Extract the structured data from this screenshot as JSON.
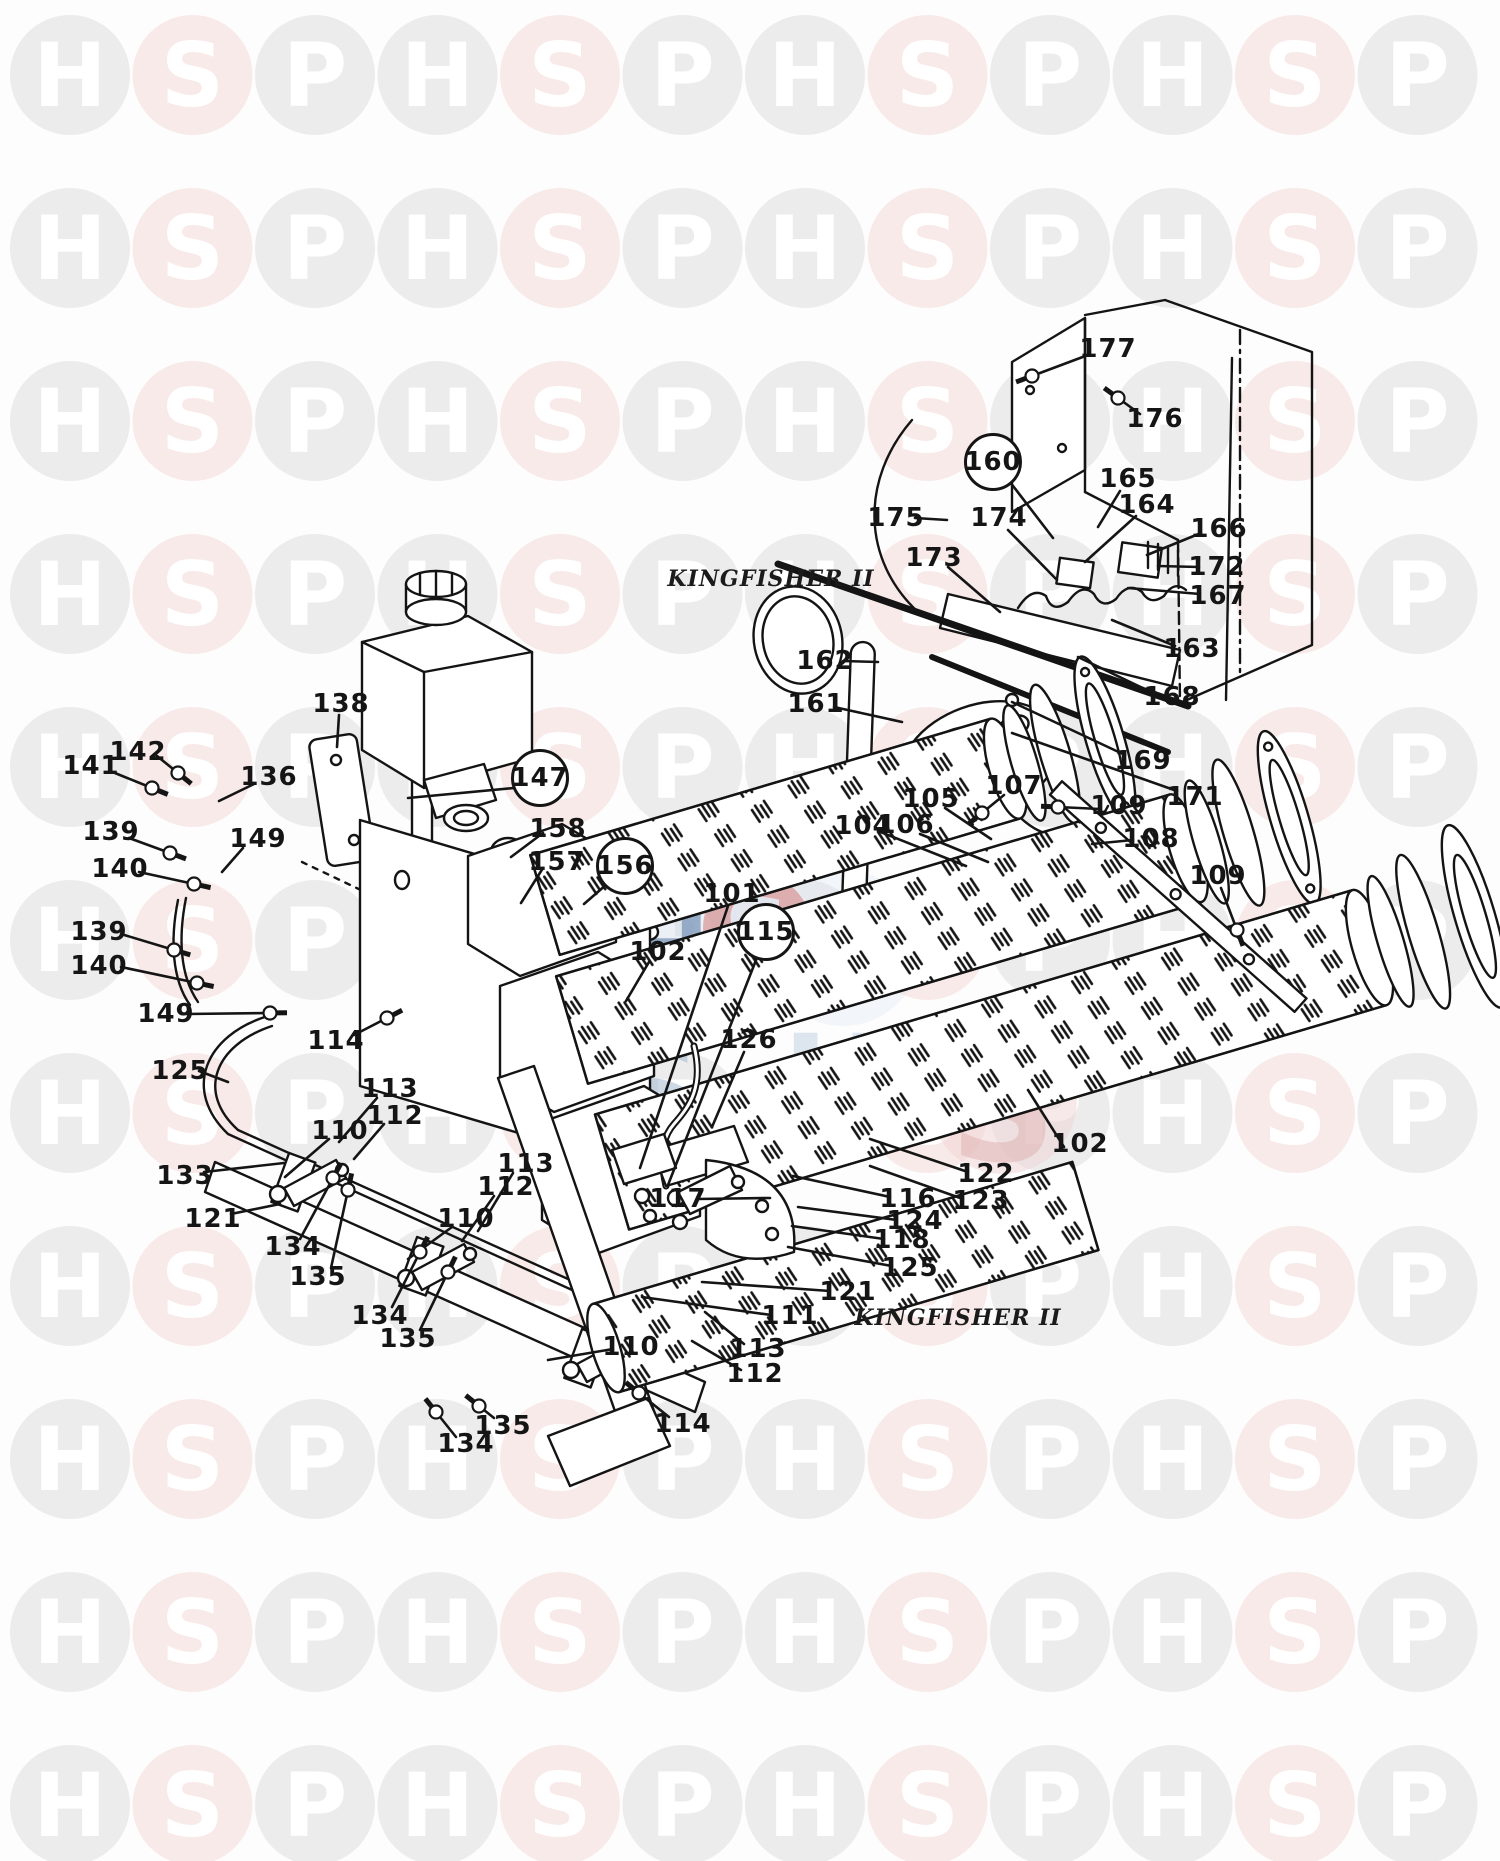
{
  "page": {
    "kind": "exploded-parts-diagram"
  },
  "titles": {
    "top": "KINGFISHER II",
    "bottom": "KINGFISHER II"
  },
  "watermark": {
    "letters": [
      "H",
      "S",
      "P"
    ],
    "gray_circle": "#ececec",
    "pink_circle": "#f8eae8",
    "letter_color": "#ffffff",
    "cols": 12,
    "rows": 11,
    "x0": 70,
    "y0": 75,
    "dx": 122.5,
    "dy": 173,
    "radius": 60,
    "font_size": 88
  },
  "center_logo": {
    "items": [
      {
        "type": "disc",
        "x": 660,
        "y": 950,
        "r": 85,
        "color": "#ccd9e8",
        "opacity": 0.4
      },
      {
        "type": "disc",
        "x": 843,
        "y": 948,
        "r": 78,
        "color": "#dce6f0",
        "opacity": 0.35
      },
      {
        "type": "disc",
        "x": 757,
        "y": 928,
        "r": 54,
        "color": "#d99494",
        "opacity": 0.7
      },
      {
        "type": "letter",
        "ch": "H",
        "x": 668,
        "y": 948,
        "size": 100,
        "color": "#7d97ba",
        "opacity": 0.75
      },
      {
        "type": "letter",
        "ch": "S",
        "x": 757,
        "y": 932,
        "size": 92,
        "color": "#e4edf5",
        "opacity": 0.9
      },
      {
        "type": "letter",
        "ch": "P",
        "x": 843,
        "y": 947,
        "size": 100,
        "color": "#7d97ba",
        "opacity": 0.75
      },
      {
        "type": "letter",
        "ch": "S",
        "x": 652,
        "y": 1092,
        "size": 148,
        "color": "#9fb5cf",
        "opacity": 0.5
      },
      {
        "type": "letter",
        "ch": "H",
        "x": 835,
        "y": 1080,
        "size": 126,
        "color": "#b8c9dc",
        "opacity": 0.45
      },
      {
        "type": "disc",
        "x": 1003,
        "y": 1100,
        "r": 74,
        "color": "#f0d4d4",
        "opacity": 0.5
      },
      {
        "type": "letter",
        "ch": "S",
        "x": 1003,
        "y": 1108,
        "size": 148,
        "color": "#dfb4b4",
        "opacity": 0.55
      }
    ]
  },
  "callouts": [
    {
      "t": "177",
      "x": 1108,
      "y": 349,
      "l": [
        1088,
        355,
        1032,
        376
      ],
      "b": 1
    },
    {
      "t": "176",
      "x": 1155,
      "y": 419,
      "l": [
        1140,
        414,
        1118,
        398
      ],
      "b": 1
    },
    {
      "t": "160",
      "x": 993,
      "y": 462,
      "c": 1,
      "l": [
        1010,
        482,
        1053,
        538
      ]
    },
    {
      "t": "165",
      "x": 1128,
      "y": 479,
      "l": [
        1120,
        491,
        1098,
        527
      ]
    },
    {
      "t": "164",
      "x": 1147,
      "y": 505,
      "l": [
        1136,
        516,
        1085,
        562
      ]
    },
    {
      "t": "166",
      "x": 1219,
      "y": 529,
      "l": [
        1201,
        533,
        1147,
        555
      ]
    },
    {
      "t": "172",
      "x": 1217,
      "y": 567,
      "l": [
        1199,
        567,
        1158,
        566
      ]
    },
    {
      "t": "167",
      "x": 1218,
      "y": 596,
      "l": [
        1200,
        594,
        1128,
        588
      ]
    },
    {
      "t": "163",
      "x": 1192,
      "y": 649,
      "l": [
        1175,
        646,
        1112,
        620
      ]
    },
    {
      "t": "168",
      "x": 1172,
      "y": 697,
      "l": [
        1155,
        694,
        1078,
        657
      ]
    },
    {
      "t": "169",
      "x": 1143,
      "y": 761,
      "l": [
        1125,
        755,
        1012,
        702
      ]
    },
    {
      "t": "171",
      "x": 1195,
      "y": 797,
      "l": [
        1177,
        791,
        1012,
        733
      ]
    },
    {
      "t": "175",
      "x": 896,
      "y": 518,
      "l": [
        915,
        518,
        947,
        520
      ]
    },
    {
      "t": "174",
      "x": 999,
      "y": 518,
      "l": [
        1008,
        530,
        1057,
        580
      ]
    },
    {
      "t": "173",
      "x": 934,
      "y": 558,
      "l": [
        948,
        567,
        1000,
        612
      ]
    },
    {
      "t": "162",
      "x": 825,
      "y": 661,
      "l": [
        843,
        661,
        878,
        662
      ]
    },
    {
      "t": "161",
      "x": 816,
      "y": 704,
      "l": [
        834,
        707,
        902,
        722
      ]
    },
    {
      "t": "138",
      "x": 341,
      "y": 704,
      "l": [
        339,
        715,
        337,
        747
      ]
    },
    {
      "t": "142",
      "x": 138,
      "y": 752,
      "l": [
        157,
        756,
        178,
        773
      ],
      "b": 1
    },
    {
      "t": "141",
      "x": 91,
      "y": 766,
      "l": [
        110,
        771,
        152,
        788
      ],
      "b": 1
    },
    {
      "t": "136",
      "x": 269,
      "y": 777,
      "l": [
        254,
        784,
        219,
        801
      ]
    },
    {
      "t": "139",
      "x": 111,
      "y": 832,
      "l": [
        129,
        838,
        170,
        853
      ],
      "b": 1
    },
    {
      "t": "149",
      "x": 258,
      "y": 839,
      "l": [
        243,
        848,
        222,
        872
      ]
    },
    {
      "t": "140",
      "x": 120,
      "y": 869,
      "l": [
        139,
        872,
        194,
        884
      ],
      "b": 1
    },
    {
      "t": "147",
      "x": 540,
      "y": 778,
      "c": 1,
      "l": [
        514,
        788,
        408,
        798
      ]
    },
    {
      "t": "158",
      "x": 558,
      "y": 829,
      "l": [
        543,
        833,
        511,
        857
      ]
    },
    {
      "t": "157",
      "x": 557,
      "y": 862,
      "l": [
        543,
        868,
        521,
        903
      ]
    },
    {
      "t": "156",
      "x": 625,
      "y": 866,
      "c": 1,
      "l": [
        607,
        884,
        584,
        904
      ]
    },
    {
      "t": "139",
      "x": 99,
      "y": 932,
      "l": [
        121,
        934,
        174,
        950
      ],
      "b": 1
    },
    {
      "t": "140",
      "x": 99,
      "y": 966,
      "l": [
        121,
        967,
        197,
        983
      ],
      "b": 1
    },
    {
      "t": "149",
      "x": 166,
      "y": 1014,
      "l": [
        186,
        1014,
        270,
        1013
      ],
      "b": 1
    },
    {
      "t": "114",
      "x": 336,
      "y": 1041,
      "l": [
        354,
        1035,
        387,
        1018
      ],
      "b": 1
    },
    {
      "t": "125",
      "x": 180,
      "y": 1071,
      "l": [
        199,
        1071,
        228,
        1082
      ]
    },
    {
      "t": "101",
      "x": 732,
      "y": 894,
      "l": [
        728,
        906,
        640,
        1168
      ]
    },
    {
      "t": "115",
      "x": 766,
      "y": 932,
      "c": 1,
      "l": [
        758,
        955,
        668,
        1185
      ]
    },
    {
      "t": "102",
      "x": 658,
      "y": 952,
      "l": [
        649,
        962,
        626,
        1001
      ]
    },
    {
      "t": "104",
      "x": 863,
      "y": 826,
      "l": [
        878,
        831,
        966,
        866
      ]
    },
    {
      "t": "106",
      "x": 906,
      "y": 825,
      "l": [
        920,
        834,
        988,
        862
      ]
    },
    {
      "t": "105",
      "x": 931,
      "y": 799,
      "l": [
        945,
        808,
        991,
        839
      ]
    },
    {
      "t": "107",
      "x": 1014,
      "y": 786,
      "l": [
        1004,
        795,
        982,
        813
      ],
      "b": 1
    },
    {
      "t": "109",
      "x": 1119,
      "y": 806,
      "l": [
        1100,
        809,
        1058,
        807
      ],
      "b": 1
    },
    {
      "t": "108",
      "x": 1151,
      "y": 839,
      "l": [
        1133,
        840,
        1092,
        844
      ]
    },
    {
      "t": "109",
      "x": 1218,
      "y": 876,
      "l": [
        1221,
        888,
        1237,
        930
      ],
      "b": 1
    },
    {
      "t": "126",
      "x": 749,
      "y": 1040,
      "l": [
        744,
        1052,
        712,
        1127
      ]
    },
    {
      "t": "102",
      "x": 1080,
      "y": 1144,
      "l": [
        1064,
        1147,
        1028,
        1090
      ]
    },
    {
      "t": "122",
      "x": 986,
      "y": 1174,
      "l": [
        968,
        1172,
        870,
        1139
      ]
    },
    {
      "t": "123",
      "x": 981,
      "y": 1201,
      "l": [
        963,
        1199,
        870,
        1166
      ]
    },
    {
      "t": "113",
      "x": 390,
      "y": 1089,
      "l": [
        377,
        1098,
        339,
        1142
      ]
    },
    {
      "t": "112",
      "x": 395,
      "y": 1116,
      "l": [
        384,
        1124,
        354,
        1159
      ]
    },
    {
      "t": "110",
      "x": 340,
      "y": 1131,
      "l": [
        329,
        1139,
        285,
        1177
      ]
    },
    {
      "t": "133",
      "x": 185,
      "y": 1176,
      "l": [
        204,
        1172,
        284,
        1163
      ]
    },
    {
      "t": "121",
      "x": 213,
      "y": 1219,
      "l": [
        231,
        1214,
        280,
        1204
      ]
    },
    {
      "t": "134",
      "x": 293,
      "y": 1247,
      "l": [
        300,
        1239,
        333,
        1178
      ],
      "b": 1
    },
    {
      "t": "135",
      "x": 318,
      "y": 1277,
      "l": [
        331,
        1268,
        348,
        1190
      ],
      "b": 1
    },
    {
      "t": "110",
      "x": 466,
      "y": 1219,
      "l": [
        452,
        1227,
        408,
        1259
      ]
    },
    {
      "t": "112",
      "x": 506,
      "y": 1187,
      "l": [
        494,
        1196,
        462,
        1241
      ]
    },
    {
      "t": "113",
      "x": 526,
      "y": 1164,
      "l": [
        513,
        1173,
        478,
        1231
      ]
    },
    {
      "t": "134",
      "x": 380,
      "y": 1316,
      "l": [
        392,
        1307,
        420,
        1252
      ],
      "b": 1
    },
    {
      "t": "135",
      "x": 408,
      "y": 1339,
      "l": [
        420,
        1330,
        448,
        1272
      ],
      "b": 1
    },
    {
      "t": "117",
      "x": 678,
      "y": 1199,
      "l": [
        698,
        1199,
        770,
        1198
      ]
    },
    {
      "t": "116",
      "x": 908,
      "y": 1199,
      "l": [
        890,
        1197,
        793,
        1176
      ]
    },
    {
      "t": "124",
      "x": 915,
      "y": 1221,
      "l": [
        897,
        1220,
        798,
        1207
      ]
    },
    {
      "t": "118",
      "x": 902,
      "y": 1240,
      "l": [
        884,
        1239,
        792,
        1226
      ]
    },
    {
      "t": "125",
      "x": 910,
      "y": 1268,
      "l": [
        892,
        1266,
        788,
        1247
      ]
    },
    {
      "t": "121",
      "x": 848,
      "y": 1292,
      "l": [
        830,
        1291,
        702,
        1282
      ]
    },
    {
      "t": "111",
      "x": 790,
      "y": 1316,
      "l": [
        771,
        1315,
        642,
        1297
      ]
    },
    {
      "t": "110",
      "x": 631,
      "y": 1347,
      "l": [
        613,
        1349,
        548,
        1360
      ]
    },
    {
      "t": "113",
      "x": 758,
      "y": 1349,
      "l": [
        744,
        1344,
        705,
        1312
      ]
    },
    {
      "t": "112",
      "x": 755,
      "y": 1374,
      "l": [
        741,
        1370,
        692,
        1341
      ]
    },
    {
      "t": "135",
      "x": 503,
      "y": 1426,
      "l": [
        494,
        1418,
        479,
        1406
      ],
      "b": 1
    },
    {
      "t": "134",
      "x": 466,
      "y": 1444,
      "l": [
        456,
        1437,
        436,
        1412
      ],
      "b": 1
    },
    {
      "t": "114",
      "x": 683,
      "y": 1424,
      "l": [
        669,
        1417,
        639,
        1393
      ],
      "b": 1
    }
  ]
}
